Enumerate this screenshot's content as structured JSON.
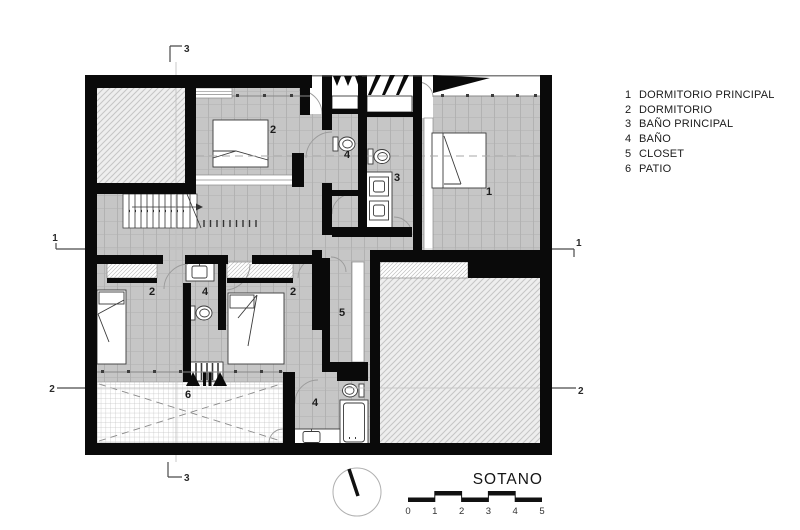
{
  "title": "SOTANO",
  "legend": {
    "items": [
      {
        "num": "1",
        "label": "DORMITORIO PRINCIPAL"
      },
      {
        "num": "2",
        "label": "DORMITORIO"
      },
      {
        "num": "3",
        "label": "BAÑO PRINCIPAL"
      },
      {
        "num": "4",
        "label": "BAÑO"
      },
      {
        "num": "5",
        "label": "CLOSET"
      },
      {
        "num": "6",
        "label": "PATIO"
      }
    ]
  },
  "plan": {
    "room_labels": [
      {
        "room": "dormitorio-top",
        "text": "2"
      },
      {
        "room": "bano-top",
        "text": "4"
      },
      {
        "room": "bano-principal",
        "text": "3"
      },
      {
        "room": "dormitorio-principal",
        "text": "1"
      },
      {
        "room": "dormitorio-lower-left",
        "text": "2"
      },
      {
        "room": "bano-lower-middle",
        "text": "4"
      },
      {
        "room": "dormitorio-lower-right",
        "text": "2"
      },
      {
        "room": "closet",
        "text": "5"
      },
      {
        "room": "patio",
        "text": "6"
      },
      {
        "room": "bano-bottom",
        "text": "4"
      }
    ],
    "section_markers": {
      "s1_left": "1",
      "s1_right": "1",
      "s2_left": "2",
      "s2_right": "2",
      "s3_top": "3",
      "s3_bottom": "3"
    }
  },
  "scale_bar": {
    "ticks": [
      "0",
      "1",
      "2",
      "3",
      "4",
      "5"
    ]
  },
  "colors": {
    "wall": "#0a0a0a",
    "floor_tile": "#c6c6c6",
    "tile_line": "#a3a3a3",
    "hatch_bg": "#eeeeee",
    "hatch_line": "#c5c5c5",
    "patio_grid": "#c3c3c3",
    "fixture_stroke": "#3a3a3a"
  }
}
